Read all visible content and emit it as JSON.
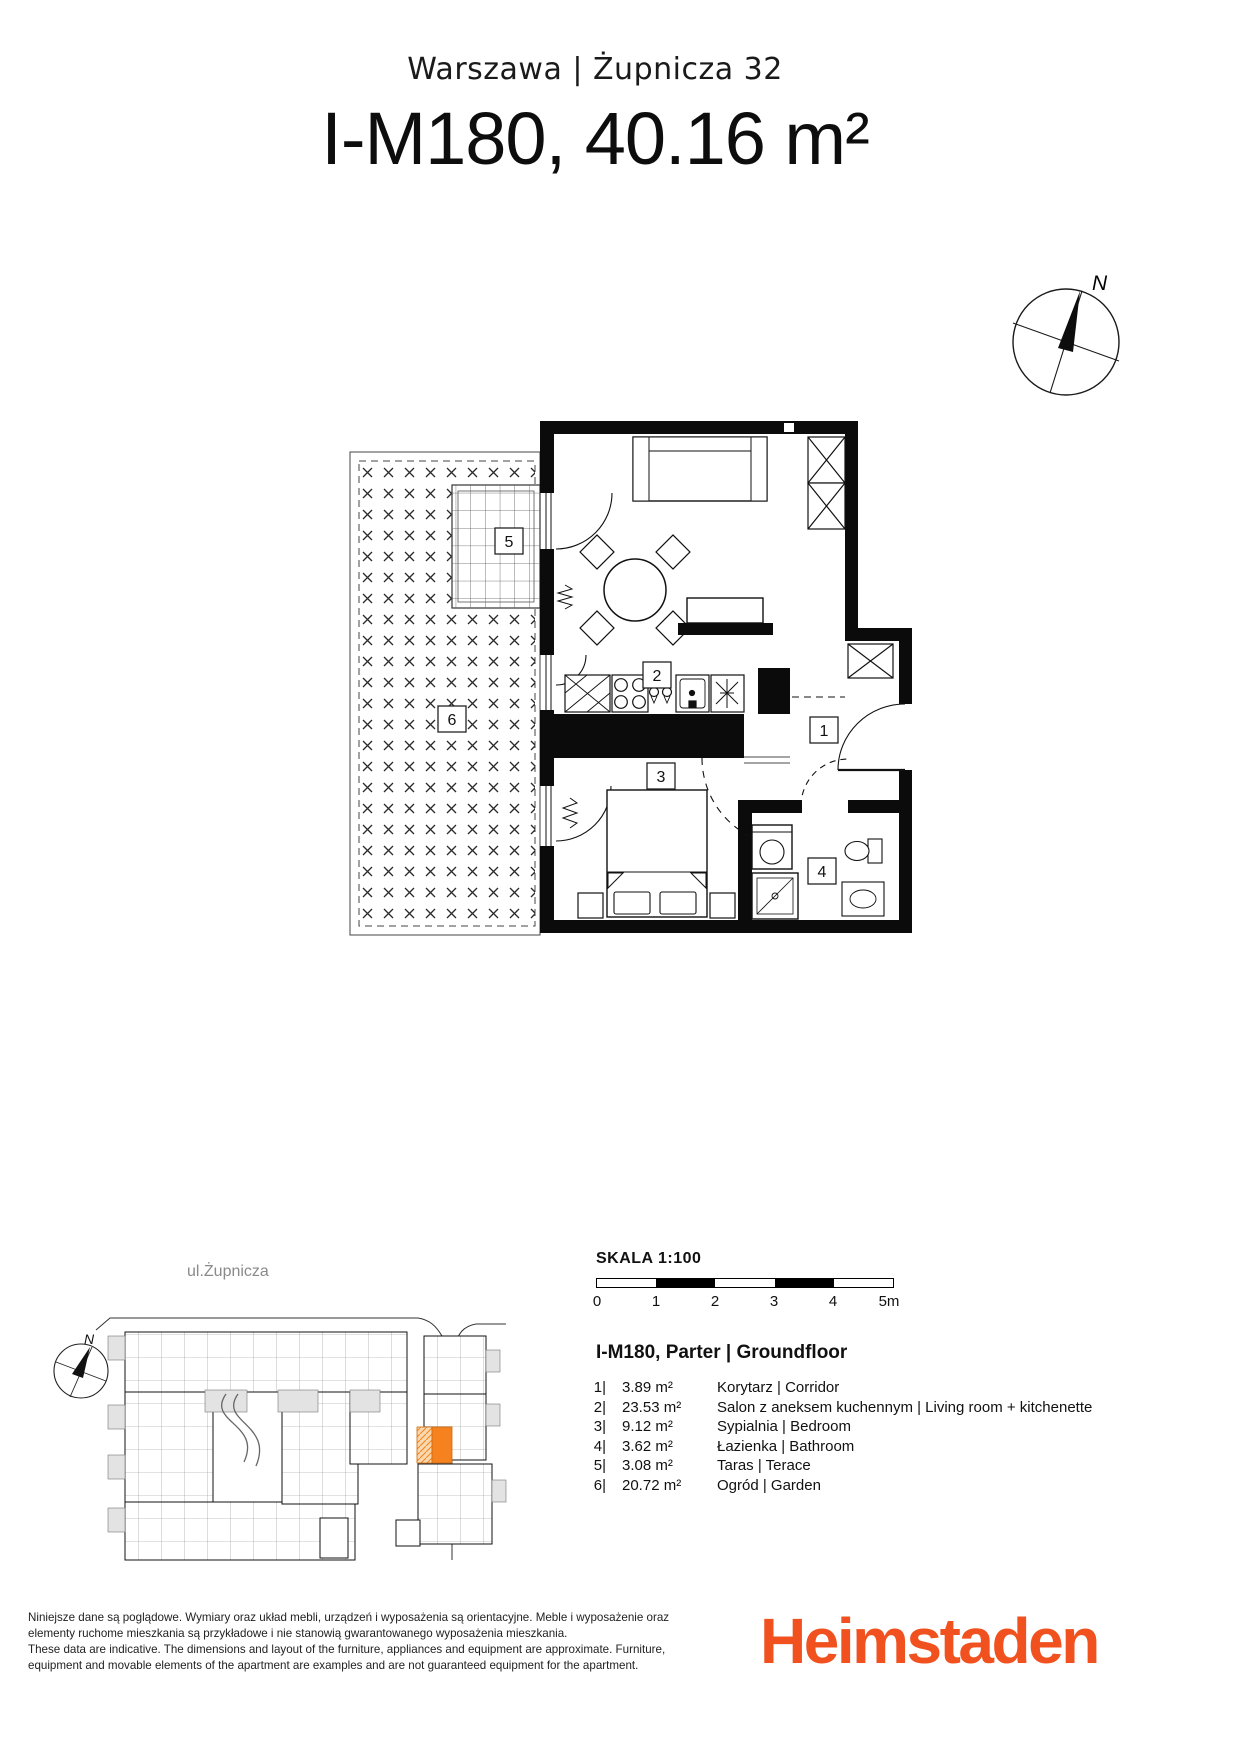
{
  "header": {
    "location": "Warszawa | Żupnicza 32",
    "title": "I-M180, 40.16 m²"
  },
  "compass": {
    "label": "N"
  },
  "floor_plan": {
    "labels": {
      "r1": "1",
      "r2": "2",
      "r3": "3",
      "r4": "4",
      "r5": "5",
      "r6": "6"
    }
  },
  "site_plan": {
    "street_label": "ul.Żupnicza",
    "compass_label": "N",
    "highlight_color": "#F6821F"
  },
  "scale": {
    "heading": "SKALA 1:100",
    "ticks": [
      "0",
      "1",
      "2",
      "3",
      "4",
      "5m"
    ]
  },
  "unit": {
    "heading": "I-M180, Parter | Groundfloor",
    "rooms": [
      {
        "num": "1|",
        "area": "3.89 m²",
        "name": "Korytarz | Corridor"
      },
      {
        "num": "2|",
        "area": "23.53 m²",
        "name": "Salon z aneksem kuchennym | Living room + kitchenette"
      },
      {
        "num": "3|",
        "area": "9.12 m²",
        "name": "Sypialnia | Bedroom"
      },
      {
        "num": "4|",
        "area": "3.62 m²",
        "name": "Łazienka | Bathroom"
      },
      {
        "num": "5|",
        "area": "3.08 m²",
        "name": "Taras | Terace"
      },
      {
        "num": "6|",
        "area": "20.72 m²",
        "name": "Ogród | Garden"
      }
    ]
  },
  "disclaimer": {
    "lines": [
      "Niniejsze dane są poglądowe. Wymiary oraz układ mebli, urządzeń i wyposażenia są orientacyjne. Meble i wyposażenie oraz",
      "elementy ruchome mieszkania są przykładowe i nie stanowią gwarantowanego wyposażenia mieszkania.",
      "These data are indicative. The dimensions and layout of the furniture, appliances and equipment are approximate. Furniture,",
      "equipment and movable elements of the apartment are examples and are not guaranteed equipment for the apartment."
    ]
  },
  "logo": {
    "text": "Heimstaden",
    "color": "#F0511F"
  }
}
